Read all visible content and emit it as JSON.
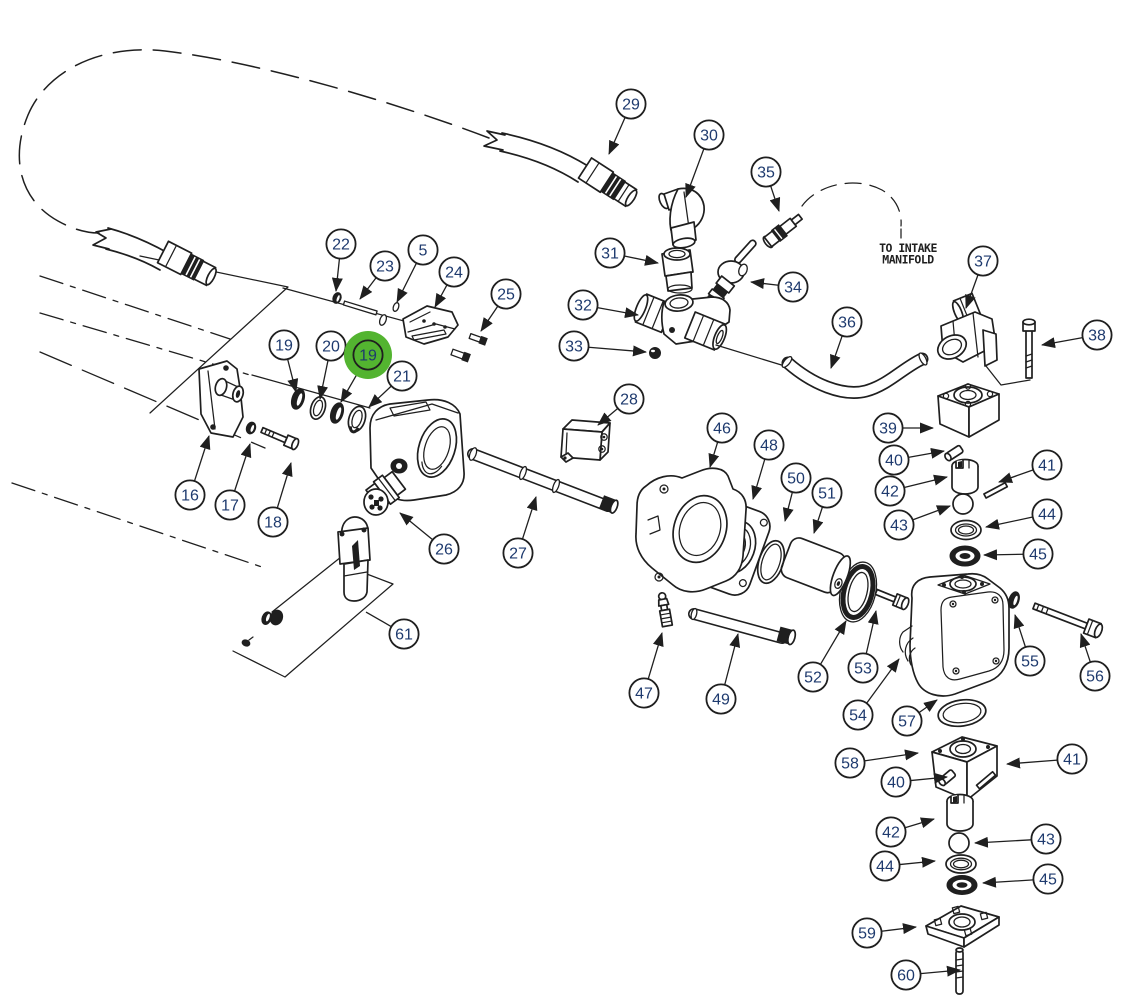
{
  "diagram": {
    "type": "exploded-parts-diagram",
    "description": "pump-assembly-exploded-view",
    "annotations": {
      "intake_line1": "TO INTAKE",
      "intake_line2": "MANIFOLD"
    },
    "colors": {
      "line": "#1f1f1f",
      "balloon_text": "#1e3a6e",
      "balloon_fill": "#ffffff",
      "highlight": "#53b430",
      "background": "#ffffff"
    },
    "selected_callout": "19",
    "balloons": [
      {
        "label": "5",
        "x": 423,
        "y": 250,
        "tip_x": 397,
        "tip_y": 302
      },
      {
        "label": "16",
        "x": 190,
        "y": 495,
        "tip_x": 209,
        "tip_y": 436
      },
      {
        "label": "17",
        "x": 230,
        "y": 505,
        "tip_x": 250,
        "tip_y": 444
      },
      {
        "label": "18",
        "x": 273,
        "y": 522,
        "tip_x": 291,
        "tip_y": 463
      },
      {
        "label": "19",
        "x": 284,
        "y": 345,
        "tip_x": 296,
        "tip_y": 392
      },
      {
        "label": "20",
        "x": 331,
        "y": 346,
        "tip_x": 320,
        "tip_y": 399
      },
      {
        "label": "19",
        "x": 368,
        "y": 355,
        "tip_x": 341,
        "tip_y": 402,
        "highlight": true
      },
      {
        "label": "21",
        "x": 402,
        "y": 376,
        "tip_x": 369,
        "tip_y": 407
      },
      {
        "label": "22",
        "x": 341,
        "y": 244,
        "tip_x": 336,
        "tip_y": 291
      },
      {
        "label": "23",
        "x": 385,
        "y": 266,
        "tip_x": 360,
        "tip_y": 299
      },
      {
        "label": "24",
        "x": 454,
        "y": 272,
        "tip_x": 435,
        "tip_y": 307
      },
      {
        "label": "25",
        "x": 506,
        "y": 294,
        "tip_x": 481,
        "tip_y": 331
      },
      {
        "label": "26",
        "x": 444,
        "y": 549,
        "tip_x": 400,
        "tip_y": 513
      },
      {
        "label": "27",
        "x": 518,
        "y": 553,
        "tip_x": 536,
        "tip_y": 497
      },
      {
        "label": "28",
        "x": 629,
        "y": 399,
        "tip_x": 598,
        "tip_y": 425
      },
      {
        "label": "29",
        "x": 631,
        "y": 104,
        "tip_x": 609,
        "tip_y": 154
      },
      {
        "label": "30",
        "x": 709,
        "y": 135,
        "tip_x": 686,
        "tip_y": 197
      },
      {
        "label": "31",
        "x": 610,
        "y": 253,
        "tip_x": 658,
        "tip_y": 263
      },
      {
        "label": "32",
        "x": 583,
        "y": 305,
        "tip_x": 638,
        "tip_y": 315
      },
      {
        "label": "33",
        "x": 574,
        "y": 346,
        "tip_x": 646,
        "tip_y": 352
      },
      {
        "label": "34",
        "x": 793,
        "y": 287,
        "tip_x": 751,
        "tip_y": 282
      },
      {
        "label": "35",
        "x": 766,
        "y": 172,
        "tip_x": 779,
        "tip_y": 211
      },
      {
        "label": "36",
        "x": 847,
        "y": 322,
        "tip_x": 831,
        "tip_y": 368
      },
      {
        "label": "37",
        "x": 983,
        "y": 261,
        "tip_x": 966,
        "tip_y": 308
      },
      {
        "label": "38",
        "x": 1097,
        "y": 335,
        "tip_x": 1042,
        "tip_y": 345
      },
      {
        "label": "39",
        "x": 888,
        "y": 428,
        "tip_x": 933,
        "tip_y": 428
      },
      {
        "label": "40",
        "x": 894,
        "y": 460,
        "tip_x": 944,
        "tip_y": 451
      },
      {
        "label": "41",
        "x": 1047,
        "y": 465,
        "tip_x": 999,
        "tip_y": 482
      },
      {
        "label": "42",
        "x": 890,
        "y": 491,
        "tip_x": 947,
        "tip_y": 477
      },
      {
        "label": "43",
        "x": 899,
        "y": 525,
        "tip_x": 950,
        "tip_y": 506
      },
      {
        "label": "44",
        "x": 1047,
        "y": 514,
        "tip_x": 986,
        "tip_y": 527
      },
      {
        "label": "45",
        "x": 1038,
        "y": 554,
        "tip_x": 984,
        "tip_y": 555
      },
      {
        "label": "46",
        "x": 722,
        "y": 428,
        "tip_x": 710,
        "tip_y": 467
      },
      {
        "label": "47",
        "x": 644,
        "y": 693,
        "tip_x": 662,
        "tip_y": 633
      },
      {
        "label": "48",
        "x": 769,
        "y": 445,
        "tip_x": 753,
        "tip_y": 499
      },
      {
        "label": "49",
        "x": 721,
        "y": 699,
        "tip_x": 738,
        "tip_y": 634
      },
      {
        "label": "50",
        "x": 796,
        "y": 478,
        "tip_x": 785,
        "tip_y": 521
      },
      {
        "label": "51",
        "x": 827,
        "y": 493,
        "tip_x": 814,
        "tip_y": 533
      },
      {
        "label": "52",
        "x": 813,
        "y": 677,
        "tip_x": 846,
        "tip_y": 621
      },
      {
        "label": "53",
        "x": 863,
        "y": 668,
        "tip_x": 876,
        "tip_y": 611
      },
      {
        "label": "54",
        "x": 858,
        "y": 715,
        "tip_x": 899,
        "tip_y": 659
      },
      {
        "label": "55",
        "x": 1030,
        "y": 661,
        "tip_x": 1015,
        "tip_y": 615
      },
      {
        "label": "56",
        "x": 1095,
        "y": 676,
        "tip_x": 1081,
        "tip_y": 634
      },
      {
        "label": "57",
        "x": 907,
        "y": 721,
        "tip_x": 937,
        "tip_y": 700
      },
      {
        "label": "58",
        "x": 850,
        "y": 763,
        "tip_x": 918,
        "tip_y": 753
      },
      {
        "label": "40",
        "x": 896,
        "y": 782,
        "tip_x": 947,
        "tip_y": 777
      },
      {
        "label": "41",
        "x": 1072,
        "y": 759,
        "tip_x": 1007,
        "tip_y": 764
      },
      {
        "label": "42",
        "x": 891,
        "y": 832,
        "tip_x": 934,
        "tip_y": 819
      },
      {
        "label": "43",
        "x": 1046,
        "y": 839,
        "tip_x": 975,
        "tip_y": 843
      },
      {
        "label": "44",
        "x": 885,
        "y": 866,
        "tip_x": 935,
        "tip_y": 861
      },
      {
        "label": "45",
        "x": 1048,
        "y": 879,
        "tip_x": 983,
        "tip_y": 883
      },
      {
        "label": "59",
        "x": 867,
        "y": 933,
        "tip_x": 916,
        "tip_y": 927
      },
      {
        "label": "60",
        "x": 906,
        "y": 975,
        "tip_x": 960,
        "tip_y": 970
      },
      {
        "label": "61",
        "x": 404,
        "y": 634,
        "tip_x": 366,
        "tip_y": 612,
        "arrow": false
      }
    ]
  }
}
